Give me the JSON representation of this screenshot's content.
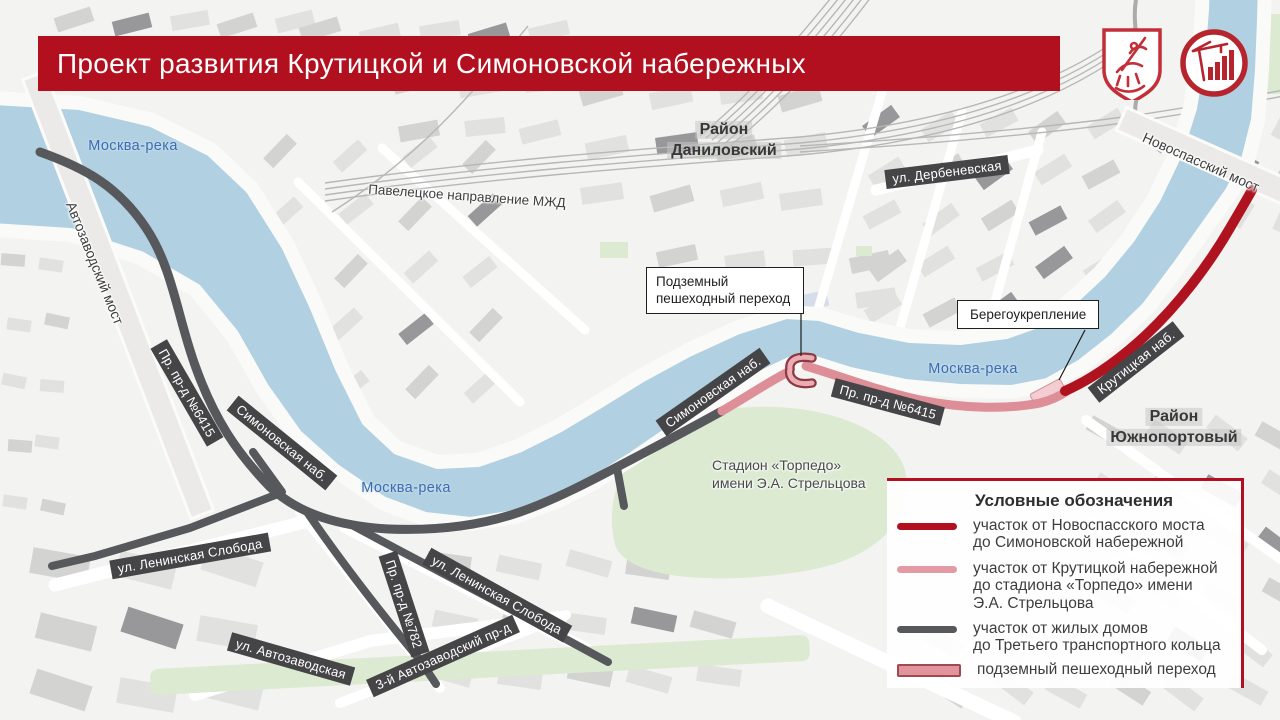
{
  "title": {
    "text": "Проект развития Крутицкой и Симоновской набережных"
  },
  "logos": {
    "coat_of_arms_icon": "moscow-coat-of-arms",
    "construction_icon": "moscow-construction-complex"
  },
  "map": {
    "river_labels": [
      "Москва-река",
      "Москва-река",
      "Москва-река"
    ],
    "bridges": [
      "Автозаводский мост",
      "Новоспасский мост"
    ],
    "railway_label": "Павелецкое направление МЖД",
    "districts": [
      {
        "line1": "Район",
        "line2": "Даниловский"
      },
      {
        "line1": "Район",
        "line2": "Южнопортовый"
      }
    ],
    "street_banners": [
      "ул. Дербеневская",
      "Симоновская наб.",
      "Симоновская наб.",
      "Пр. пр-д №6415",
      "Пр. пр-д №6415",
      "Крутицкая наб.",
      "ул. Ленинская Слобода",
      "ул. Ленинская Слобода",
      "Пр. пр-д №782",
      "3-й Автозаводский пр-д",
      "ул. Автозаводская"
    ],
    "stadium_label": "Стадион «Торпедо»\nимени Э.А. Стрельцова",
    "callouts": [
      "Подземный\nпешеходный переход",
      "Берегоукрепление"
    ]
  },
  "legend": {
    "heading": "Условные обозначения",
    "items": [
      {
        "swatch": "line",
        "color": "#b2101f",
        "text": "участок от Новоспасского моста\nдо Симоновской набережной"
      },
      {
        "swatch": "line",
        "color": "#e49aa4",
        "text": "участок от Крутицкой набережной\nдо стадиона «Торпедо» имени\nЭ.А. Стрельцова"
      },
      {
        "swatch": "line",
        "color": "#57585c",
        "text": "участок от жилых домов\nдо Третьего транспортного кольца"
      },
      {
        "swatch": "rect",
        "color": "#e2939c",
        "border": "#9e4a52",
        "text": "подземный пешеходный переход"
      }
    ]
  },
  "colors": {
    "primary": "#b2101f",
    "route_red": "#b01320",
    "route_pink": "#dd8e97",
    "route_gray": "#57585c",
    "water": "#b1d0e1",
    "river_label": "#3a6cb0"
  }
}
